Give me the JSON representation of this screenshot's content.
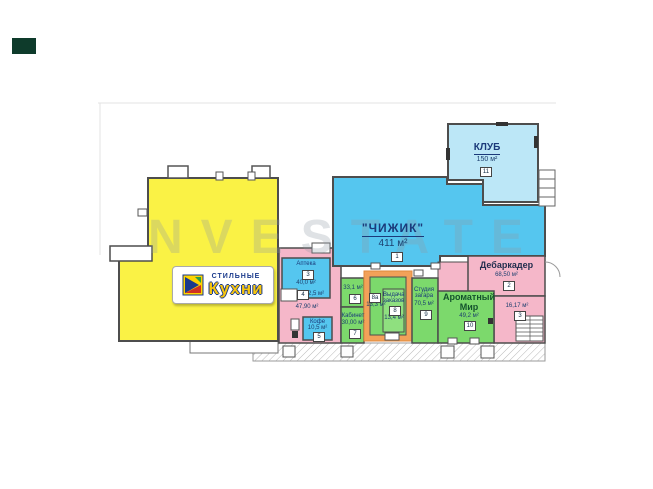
{
  "watermark": "NVESTATE",
  "brand": {
    "top": "СТИЛЬНЫЕ",
    "main": "Кухни"
  },
  "units": {
    "chizhik": {
      "label": "\"ЧИЖИК\"",
      "area": "411 м²",
      "num": "1"
    },
    "klub": {
      "label": "КЛУБ",
      "area": "150 м²",
      "num": "11"
    },
    "debarkader": {
      "label": "Дебаркадер",
      "area": "68,50 м²",
      "num": "2"
    },
    "stairs_room": {
      "area": "16,17 м²",
      "num": "3"
    },
    "aromatny_mir": {
      "label": "Ароматный Мир",
      "area": "49,2 м²",
      "num": "10"
    },
    "solarium": {
      "label": "Студия загара",
      "area": "70,5 м²",
      "num": "9"
    },
    "unit6": {
      "area": "33,1 м²",
      "num": "6"
    },
    "cabinet": {
      "label": "Кабинет",
      "area": "30,00 м²",
      "num": "7"
    },
    "unit8a": {
      "num": "8а",
      "area": "13,3 м²"
    },
    "unit8": {
      "label": "Выдача заказов",
      "area": "13,4 м²",
      "num": "8"
    },
    "apteka": {
      "label": "Аптека",
      "area": "40,0 м²",
      "num": "3"
    },
    "closet": {
      "num": "4",
      "area": "2,5 м²"
    },
    "kofe": {
      "label": "Кофе",
      "area": "10,5 м²",
      "num": "5"
    },
    "corridor": {
      "area": "47,90 м²"
    }
  },
  "colors": {
    "yellow": "#FAF245",
    "blue": "#55C6EF",
    "light_blue": "#BCE7F7",
    "green": "#7CD96C",
    "pink": "#F5B7C9",
    "highlight_orange": "#F2A159",
    "walls": "#4d4d4d"
  }
}
